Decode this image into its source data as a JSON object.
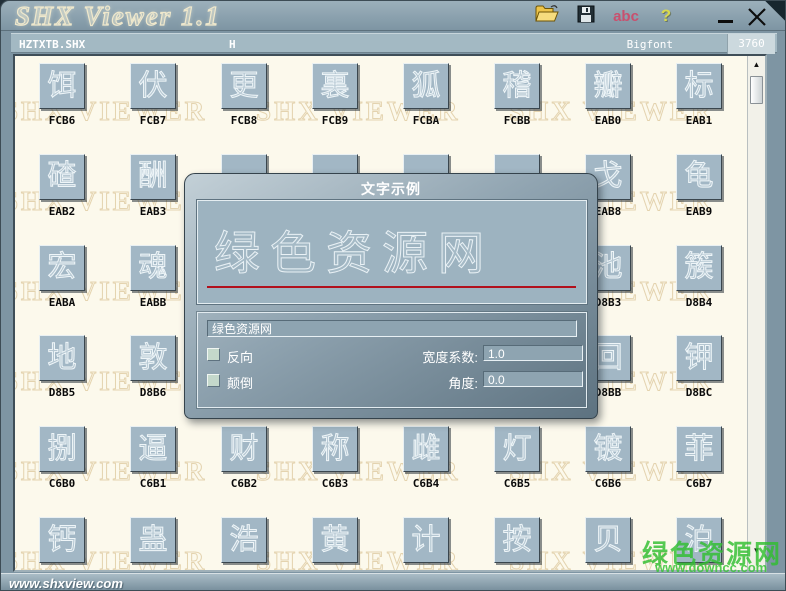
{
  "window": {
    "title": "SHX Viewer 1.1",
    "toolbar": {
      "abc_label": "abc",
      "help_label": "?"
    },
    "controls": {
      "minimize": "minimize",
      "close": "close"
    }
  },
  "statusbar": {
    "font_file": "HZTXTB.SHX",
    "sample_char": "H",
    "font_type": "Bigfont",
    "glyph_count": "3760"
  },
  "grid": {
    "watermark_text": "SHX VIEWER",
    "rows": [
      [
        {
          "char": "饵",
          "code": "FCB6"
        },
        {
          "char": "伏",
          "code": "FCB7"
        },
        {
          "char": "更",
          "code": "FCB8"
        },
        {
          "char": "裏",
          "code": "FCB9"
        },
        {
          "char": "狐",
          "code": "FCBA"
        },
        {
          "char": "稽",
          "code": "FCBB"
        },
        {
          "char": "瓣",
          "code": "EAB0"
        },
        {
          "char": "标",
          "code": "EAB1"
        }
      ],
      [
        {
          "char": "碴",
          "code": "EAB2"
        },
        {
          "char": "酬",
          "code": "EAB3"
        },
        {
          "char": "",
          "code": ""
        },
        {
          "char": "",
          "code": ""
        },
        {
          "char": "",
          "code": ""
        },
        {
          "char": "",
          "code": ""
        },
        {
          "char": "戈",
          "code": "EAB8"
        },
        {
          "char": "龟",
          "code": "EAB9"
        }
      ],
      [
        {
          "char": "宏",
          "code": "EABA"
        },
        {
          "char": "魂",
          "code": "EABB"
        },
        {
          "char": "",
          "code": ""
        },
        {
          "char": "",
          "code": ""
        },
        {
          "char": "",
          "code": ""
        },
        {
          "char": "",
          "code": ""
        },
        {
          "char": "池",
          "code": "D8B3"
        },
        {
          "char": "簇",
          "code": "D8B4"
        }
      ],
      [
        {
          "char": "地",
          "code": "D8B5"
        },
        {
          "char": "敦",
          "code": "D8B6"
        },
        {
          "char": "",
          "code": ""
        },
        {
          "char": "",
          "code": ""
        },
        {
          "char": "",
          "code": ""
        },
        {
          "char": "",
          "code": ""
        },
        {
          "char": "回",
          "code": "D8BB"
        },
        {
          "char": "钾",
          "code": "D8BC"
        }
      ],
      [
        {
          "char": "捌",
          "code": "C6B0"
        },
        {
          "char": "逼",
          "code": "C6B1"
        },
        {
          "char": "财",
          "code": "C6B2"
        },
        {
          "char": "称",
          "code": "C6B3"
        },
        {
          "char": "雌",
          "code": "C6B4"
        },
        {
          "char": "灯",
          "code": "C6B5"
        },
        {
          "char": "镀",
          "code": "C6B6"
        },
        {
          "char": "菲",
          "code": "C6B7"
        }
      ],
      [
        {
          "char": "钙",
          "code": ""
        },
        {
          "char": "蛊",
          "code": ""
        },
        {
          "char": "浩",
          "code": ""
        },
        {
          "char": "黄",
          "code": ""
        },
        {
          "char": "计",
          "code": ""
        },
        {
          "char": "按",
          "code": ""
        },
        {
          "char": "贝",
          "code": ""
        },
        {
          "char": "泊",
          "code": ""
        }
      ]
    ]
  },
  "dialog": {
    "title": "文字示例",
    "preview_text": "绿色资源网",
    "input_value": "绿色资源网",
    "checkbox_reverse": "反向",
    "checkbox_upsidedown": "颠倒",
    "width_factor_label": "宽度系数:",
    "width_factor_value": "1.0",
    "angle_label": "角度:",
    "angle_value": "0.0"
  },
  "footer": {
    "site": "www.shxview.com"
  },
  "site_watermark": {
    "name": "绿色资源网",
    "url": "www.downcc.com"
  },
  "colors": {
    "underline_red": "#b2101c",
    "watermark_green": "#2fbe2f",
    "titlebar": "#8ba1ae",
    "cell_button": "#a2b7c5"
  }
}
